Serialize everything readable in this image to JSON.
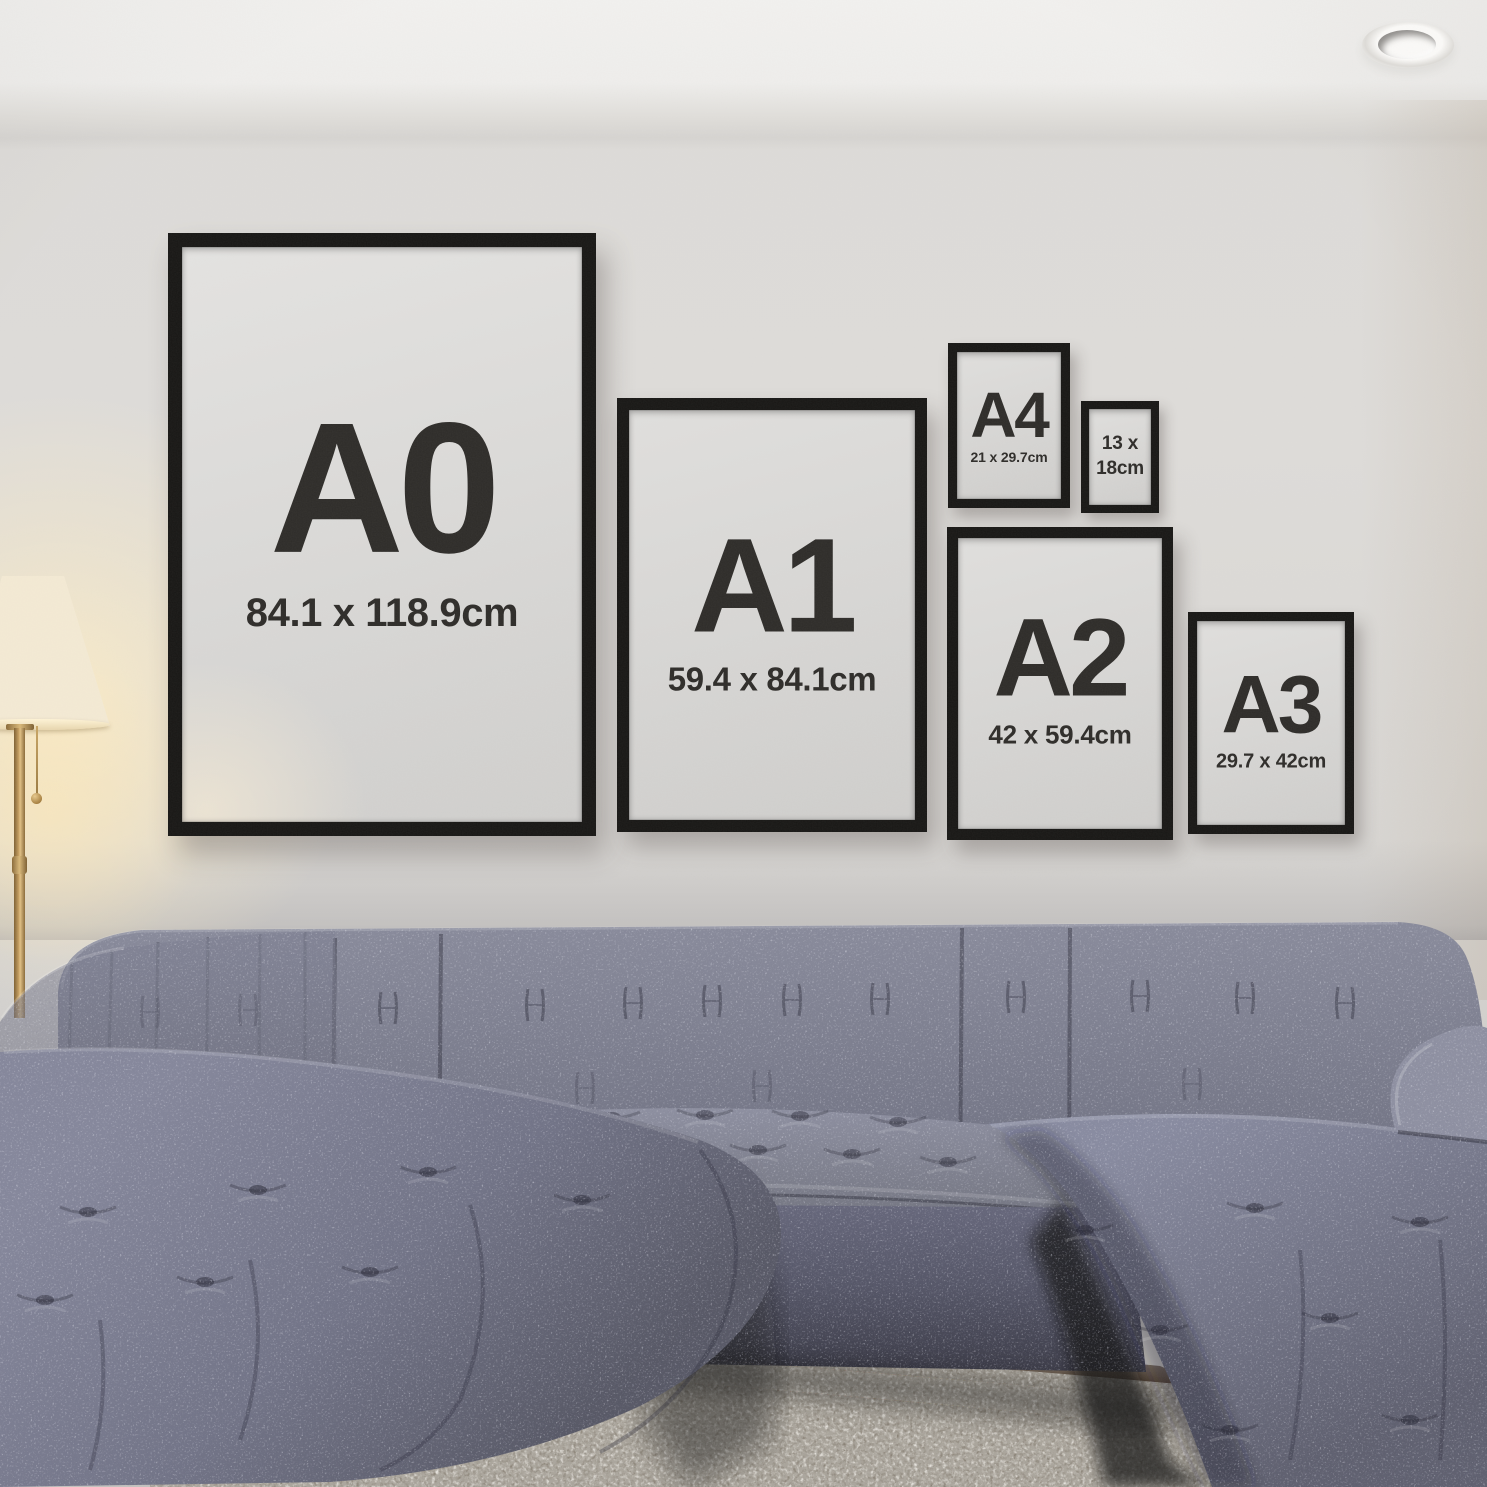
{
  "scene": {
    "colors": {
      "wall": "#dcdad7",
      "ceiling": "#f1f0ee",
      "frame_border": "#171614",
      "frame_mat": "#d9d8d6",
      "frame_text": "#2d2b28",
      "sofa_fabric": "#7b7d90",
      "sofa_shadow": "#454653",
      "rug": "#aba69d",
      "floor": "#33261c",
      "lamp_shade": "#f3e9d2",
      "lamp_glow": "#ffedc0",
      "lamp_brass": "#b28d52"
    }
  },
  "frames": [
    {
      "id": "a0",
      "label": "A0",
      "size": "84.1 x 118.9cm"
    },
    {
      "id": "a1",
      "label": "A1",
      "size": "59.4 x 84.1cm"
    },
    {
      "id": "a4",
      "label": "A4",
      "size": "21 x 29.7cm"
    },
    {
      "id": "13x18",
      "label_line1": "13 x",
      "label_line2": "18cm"
    },
    {
      "id": "a2",
      "label": "A2",
      "size": "42 x 59.4cm"
    },
    {
      "id": "a3",
      "label": "A3",
      "size": "29.7 x 42cm"
    }
  ]
}
